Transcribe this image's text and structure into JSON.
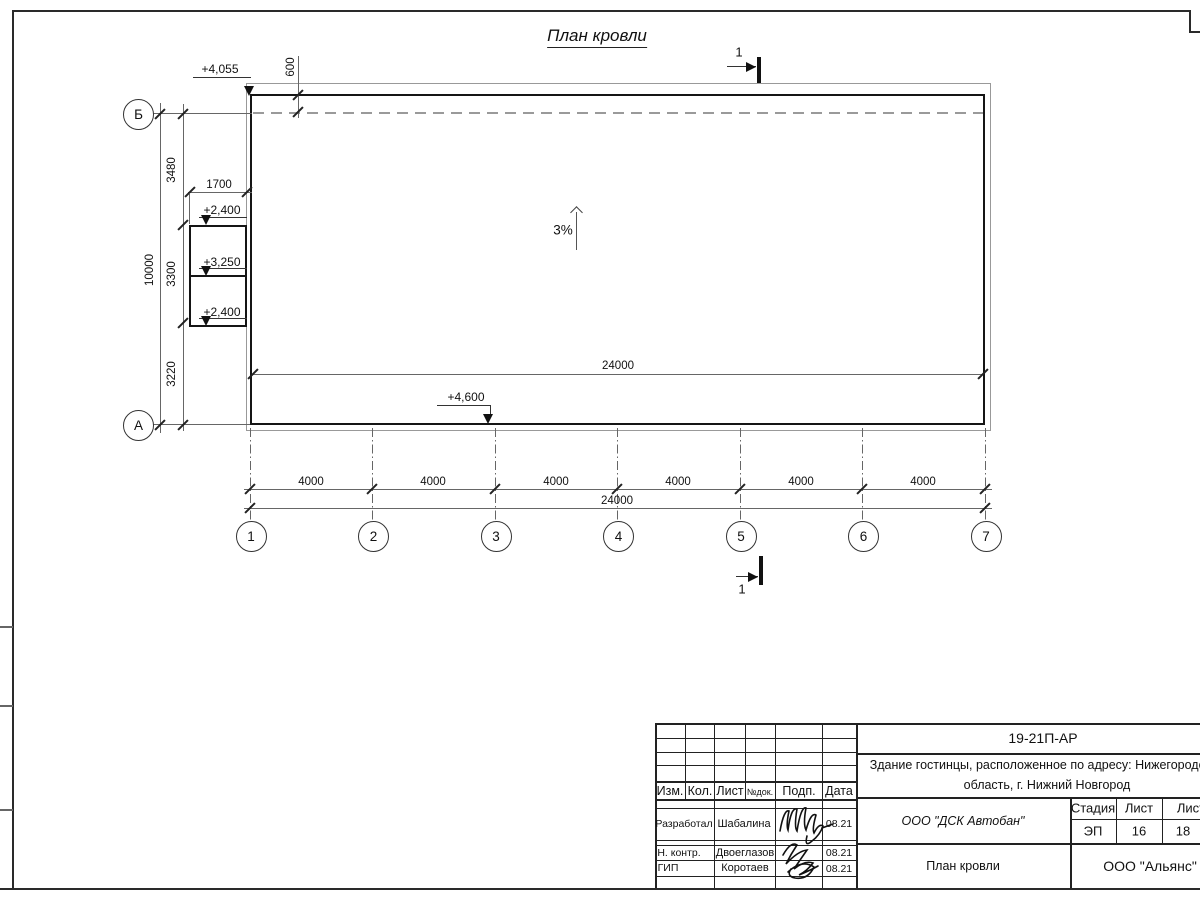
{
  "sheet": {
    "title": "План кровли"
  },
  "plan": {
    "slope": "3%",
    "section_top": "1",
    "section_bottom": "1",
    "elev_top_left": "+4,055",
    "elev_annex_top": "+2,400",
    "elev_annex_mid": "+3,250",
    "elev_annex_bot": "+2,400",
    "elev_bottom": "+4,600",
    "dim_parapet": "600",
    "dim_annex_w": "1700",
    "dim_total_v": "10000",
    "dim_seg1": "3480",
    "dim_seg2": "3300",
    "dim_seg3": "3220",
    "dim_inner_total": "24000",
    "dim_bottom_total": "24000",
    "bays": [
      "4000",
      "4000",
      "4000",
      "4000",
      "4000",
      "4000"
    ],
    "axes_num": [
      "1",
      "2",
      "3",
      "4",
      "5",
      "6",
      "7"
    ],
    "axis_b": "Б",
    "axis_a": "А"
  },
  "titleblock": {
    "doc_code": "19-21П-АР",
    "object_line1": "Здание гостинцы, расположенное по адресу: Нижегородская",
    "object_line2": "область, г. Нижний Новгород",
    "contractor": "ООО \"ДСК Автобан\"",
    "sheet_name": "План кровли",
    "company": "ООО \"Альянс\"",
    "stage_label": "Стадия",
    "list_label": "Лист",
    "listov_label": "Листов",
    "stage": "ЭП",
    "sheet_no": "16",
    "sheets_total": "18",
    "h_izm": "Изм.",
    "h_kol": "Кол.",
    "h_list": "Лист",
    "h_ndok": "№док.",
    "h_podp": "Подп.",
    "h_data": "Дата",
    "r1_role": "Разработал",
    "r1_name": "Шабалина",
    "r1_date": "08.21",
    "r2_role": "Н. контр.",
    "r2_name": "Двоеглазов",
    "r2_date": "08.21",
    "r3_role": "ГИП",
    "r3_name": "Коротаев",
    "r3_date": "08.21"
  }
}
